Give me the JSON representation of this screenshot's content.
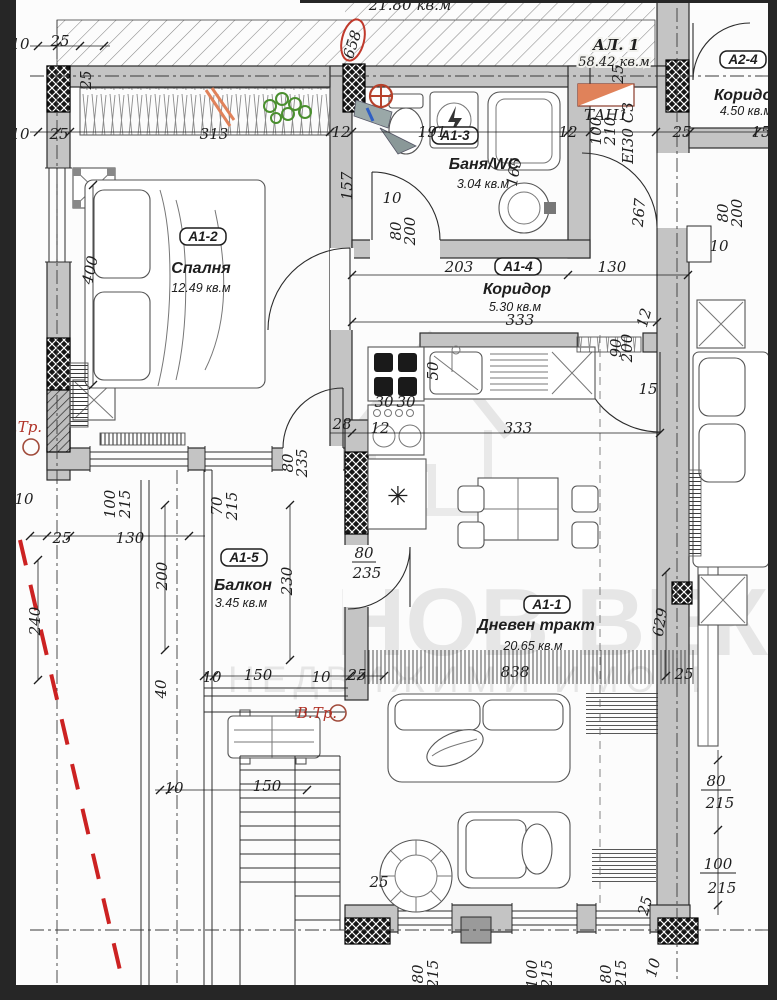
{
  "apartment": {
    "label": "АЛ. 1",
    "area": "58.42 кв.м",
    "partial_area_top": "21.80 кв.м"
  },
  "watermark": {
    "line1": "НОВ ВЕК",
    "line2": "НЕДВИЖИМИ ИМОТИ"
  },
  "rooms": [
    {
      "id": "A1-1",
      "name": "Дневен тракт",
      "area": "20.65 кв.м"
    },
    {
      "id": "A1-2",
      "name": "Спалня",
      "area": "12.49 кв.м"
    },
    {
      "id": "A1-3",
      "name": "Баня/WC",
      "area": "3.04 кв.м"
    },
    {
      "id": "A1-4",
      "name": "Коридор",
      "area": "5.30 кв.м"
    },
    {
      "id": "A1-5",
      "name": "Балкон",
      "area": "3.45 кв.м"
    },
    {
      "id": "A2-4",
      "name": "Коридор",
      "area": "4.50 кв.м"
    }
  ],
  "annotations": {
    "fire_door": "ТАН1",
    "fire_rating": "EI30 C3",
    "shaft_left": "В.Тр.",
    "shaft_balcony": "В.Тр."
  },
  "colors": {
    "wall": "#c4c4c4",
    "line": "#2b2b2b",
    "hatch": "#8a8a8a",
    "watermark": "#d9d9d9",
    "red": "#b03227",
    "orange": "#e0825a",
    "green": "#4a8f2e",
    "blue": "#2f5fc4",
    "paper": "#fcfcfc",
    "frame": "#262626"
  },
  "dimensions": [
    {
      "text": "10",
      "x": 20,
      "y": 49
    },
    {
      "text": "25",
      "x": 60,
      "y": 46
    },
    {
      "text": "25",
      "x": 91,
      "y": 80,
      "rot": -90
    },
    {
      "text": "10",
      "x": 20,
      "y": 139
    },
    {
      "text": "25",
      "x": 59,
      "y": 139
    },
    {
      "text": "313",
      "x": 214,
      "y": 139
    },
    {
      "text": "12",
      "x": 341,
      "y": 137
    },
    {
      "text": "157",
      "x": 352,
      "y": 186,
      "rot": -90
    },
    {
      "text": "191",
      "x": 432,
      "y": 137
    },
    {
      "text": "12",
      "x": 568,
      "y": 137
    },
    {
      "text": "25",
      "x": 682,
      "y": 137
    },
    {
      "text": "15",
      "x": 761,
      "y": 137
    },
    {
      "text": "658",
      "x": 357,
      "y": 46,
      "rot": -72
    },
    {
      "text": "21.80 кв.м",
      "x": 410,
      "y": 10,
      "fs": 13
    },
    {
      "text": "ТАН1",
      "x": 606,
      "y": 120,
      "fs": 12
    },
    {
      "text": "100",
      "x": 601,
      "y": 131,
      "rot": -90,
      "fs": 12
    },
    {
      "text": "210",
      "x": 615,
      "y": 131,
      "rot": -90,
      "fs": 12
    },
    {
      "text": "EI30 C3",
      "x": 633,
      "y": 133,
      "rot": -90,
      "fs": 11
    },
    {
      "text": "25",
      "x": 623,
      "y": 74,
      "rot": -90,
      "fs": 12
    },
    {
      "text": "10",
      "x": 392,
      "y": 203
    },
    {
      "text": "80",
      "x": 401,
      "y": 231,
      "rot": -90,
      "fs": 13
    },
    {
      "text": "200",
      "x": 415,
      "y": 231,
      "rot": -90,
      "fs": 13
    },
    {
      "text": "165",
      "x": 519,
      "y": 173,
      "rot": -80
    },
    {
      "text": "203",
      "x": 459,
      "y": 272
    },
    {
      "text": "130",
      "x": 612,
      "y": 272
    },
    {
      "text": "333",
      "x": 520,
      "y": 325
    },
    {
      "text": "12",
      "x": 649,
      "y": 319,
      "rot": -75
    },
    {
      "text": "267",
      "x": 644,
      "y": 213,
      "rot": -85
    },
    {
      "text": "80",
      "x": 728,
      "y": 213,
      "rot": -90,
      "fs": 13
    },
    {
      "text": "200",
      "x": 742,
      "y": 213,
      "rot": -90,
      "fs": 13
    },
    {
      "text": "10",
      "x": 719,
      "y": 251
    },
    {
      "text": "15",
      "x": 648,
      "y": 394
    },
    {
      "text": "90",
      "x": 621,
      "y": 348,
      "rot": -90,
      "fs": 11
    },
    {
      "text": "200",
      "x": 632,
      "y": 348,
      "rot": -90,
      "fs": 11
    },
    {
      "text": "50",
      "x": 438,
      "y": 371,
      "rot": -90
    },
    {
      "text": "30",
      "x": 384,
      "y": 407
    },
    {
      "text": "30",
      "x": 406,
      "y": 407
    },
    {
      "text": "12",
      "x": 380,
      "y": 433
    },
    {
      "text": "28",
      "x": 342,
      "y": 429
    },
    {
      "text": "333",
      "x": 518,
      "y": 433
    },
    {
      "text": "80",
      "x": 293,
      "y": 463,
      "rot": -90,
      "fs": 12
    },
    {
      "text": "235",
      "x": 307,
      "y": 463,
      "rot": -90,
      "fs": 12
    },
    {
      "text": "400",
      "x": 95,
      "y": 271,
      "rot": -78
    },
    {
      "text": "10",
      "x": 24,
      "y": 504
    },
    {
      "text": "100",
      "x": 115,
      "y": 504,
      "rot": -90,
      "fs": 13
    },
    {
      "text": "215",
      "x": 130,
      "y": 504,
      "rot": -90,
      "fs": 13
    },
    {
      "text": "70",
      "x": 222,
      "y": 506,
      "rot": -90,
      "fs": 13
    },
    {
      "text": "215",
      "x": 237,
      "y": 506,
      "rot": -90,
      "fs": 13
    },
    {
      "text": "25",
      "x": 62,
      "y": 543
    },
    {
      "text": "130",
      "x": 130,
      "y": 543
    },
    {
      "text": "200",
      "x": 167,
      "y": 576,
      "rot": -90
    },
    {
      "text": "230",
      "x": 292,
      "y": 581,
      "rot": -90
    },
    {
      "text": "240",
      "x": 40,
      "y": 621,
      "rot": -90
    },
    {
      "text": "40",
      "x": 166,
      "y": 689,
      "rot": -90
    },
    {
      "text": "10",
      "x": 212,
      "y": 682
    },
    {
      "text": "150",
      "x": 258,
      "y": 680
    },
    {
      "text": "10",
      "x": 321,
      "y": 682
    },
    {
      "text": "25",
      "x": 357,
      "y": 680
    },
    {
      "text": "80",
      "x": 364,
      "y": 558,
      "bar": 24
    },
    {
      "text": "235",
      "x": 367,
      "y": 578
    },
    {
      "text": "10",
      "x": 174,
      "y": 793
    },
    {
      "text": "150",
      "x": 267,
      "y": 791
    },
    {
      "text": "838",
      "x": 515,
      "y": 677
    },
    {
      "text": "629",
      "x": 665,
      "y": 623,
      "rot": -80
    },
    {
      "text": "25",
      "x": 684,
      "y": 679
    },
    {
      "text": "25",
      "x": 379,
      "y": 887
    },
    {
      "text": "25",
      "x": 650,
      "y": 907,
      "rot": -75
    },
    {
      "text": "80",
      "x": 423,
      "y": 974,
      "rot": -90,
      "fs": 13
    },
    {
      "text": "215",
      "x": 438,
      "y": 974,
      "rot": -90,
      "fs": 13
    },
    {
      "text": "100",
      "x": 537,
      "y": 974,
      "rot": -90,
      "fs": 13
    },
    {
      "text": "215",
      "x": 552,
      "y": 974,
      "rot": -90,
      "fs": 13
    },
    {
      "text": "80",
      "x": 611,
      "y": 974,
      "rot": -90,
      "fs": 13
    },
    {
      "text": "215",
      "x": 626,
      "y": 974,
      "rot": -90,
      "fs": 13
    },
    {
      "text": "10",
      "x": 658,
      "y": 969,
      "rot": -75
    },
    {
      "text": "80",
      "x": 716,
      "y": 786,
      "bar": 30
    },
    {
      "text": "215",
      "x": 720,
      "y": 808
    },
    {
      "text": "100",
      "x": 718,
      "y": 869,
      "bar": 36
    },
    {
      "text": "215",
      "x": 722,
      "y": 893
    },
    {
      "text": "В.Тр.",
      "x": 22,
      "y": 432,
      "fs": 12,
      "cls": "red"
    },
    {
      "text": "В.Тр.",
      "x": 317,
      "y": 718,
      "fs": 12,
      "cls": "red"
    }
  ],
  "dim_lines": {
    "horizontal": [
      {
        "y": 132,
        "x1": 30,
        "x2": 768,
        "xs": [
          38,
          57,
          70,
          330,
          352,
          568,
          590,
          656,
          690,
          757
        ]
      },
      {
        "y": 46,
        "x1": 30,
        "x2": 110,
        "xs": [
          38,
          57,
          80,
          104
        ]
      },
      {
        "y": 275,
        "x1": 352,
        "x2": 688,
        "xs": [
          352,
          568,
          688
        ]
      },
      {
        "y": 322,
        "x1": 352,
        "x2": 657,
        "xs": [
          352,
          657
        ]
      },
      {
        "y": 433,
        "x1": 330,
        "x2": 660,
        "xs": [
          352,
          660
        ]
      },
      {
        "y": 536,
        "x1": 30,
        "x2": 205,
        "xs": [
          30,
          47,
          70,
          189
        ]
      },
      {
        "y": 676,
        "x1": 204,
        "x2": 385,
        "xs": [
          204,
          214,
          350,
          361,
          384
        ]
      },
      {
        "y": 790,
        "x1": 155,
        "x2": 307,
        "xs": [
          160,
          170,
          307
        ]
      }
    ],
    "vertical": [
      {
        "x": 93,
        "y1": 185,
        "y2": 385,
        "ys": [
          185,
          385
        ]
      },
      {
        "x": 666,
        "y1": 572,
        "y2": 676,
        "ys": [
          572,
          676
        ]
      },
      {
        "x": 290,
        "y1": 505,
        "y2": 660,
        "ys": [
          505,
          660
        ]
      },
      {
        "x": 165,
        "y1": 505,
        "y2": 650,
        "ys": [
          505,
          650
        ]
      },
      {
        "x": 38,
        "y1": 560,
        "y2": 680,
        "ys": [
          560,
          680
        ]
      },
      {
        "x": 718,
        "y1": 750,
        "y2": 915,
        "ys": [
          760,
          830,
          905
        ]
      }
    ]
  }
}
